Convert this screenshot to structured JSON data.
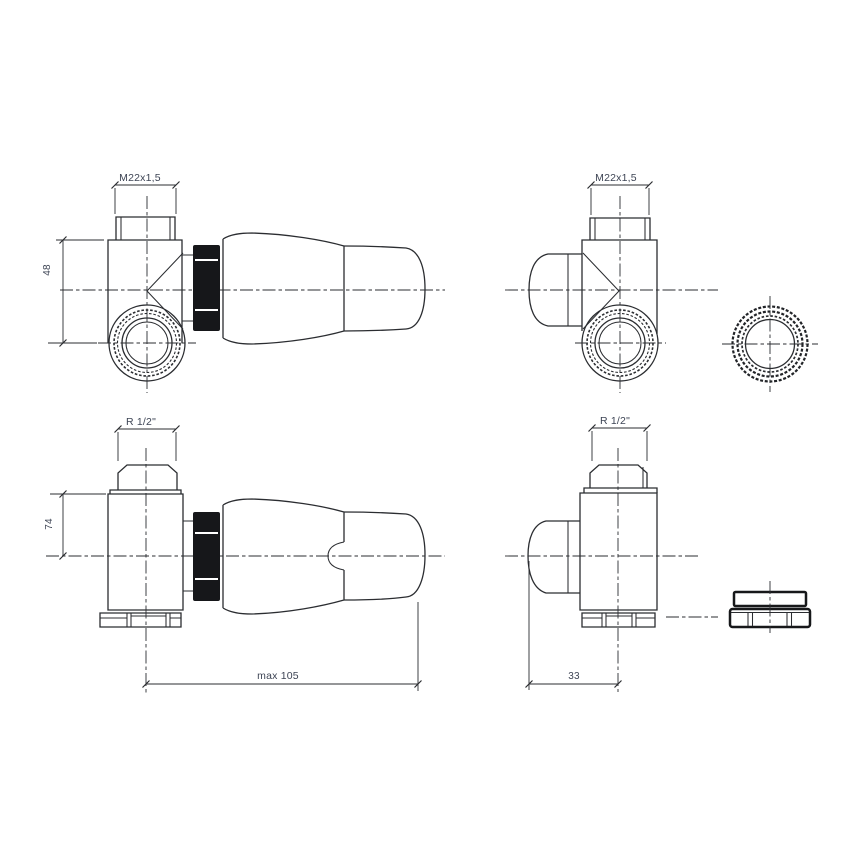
{
  "drawing": {
    "kind": "technical-line-drawing",
    "subject": "corner thermostatic radiator valve, four orthographic views with union nut accessory",
    "colors": {
      "line": "#2b2d31",
      "label": "#3d4454",
      "gland_fill": "#16171a",
      "background": "#ffffff"
    },
    "views": {
      "top_left": {
        "thread_label": "M22x1,5",
        "height_dim": "48"
      },
      "top_right": {
        "thread_label": "M22x1,5"
      },
      "bottom_left": {
        "thread_label": "R 1/2\"",
        "axis_dim": "74",
        "length_dim": "max 105"
      },
      "bottom_right": {
        "thread_label": "R 1/2\"",
        "face_to_axis_dim": "33"
      }
    }
  }
}
